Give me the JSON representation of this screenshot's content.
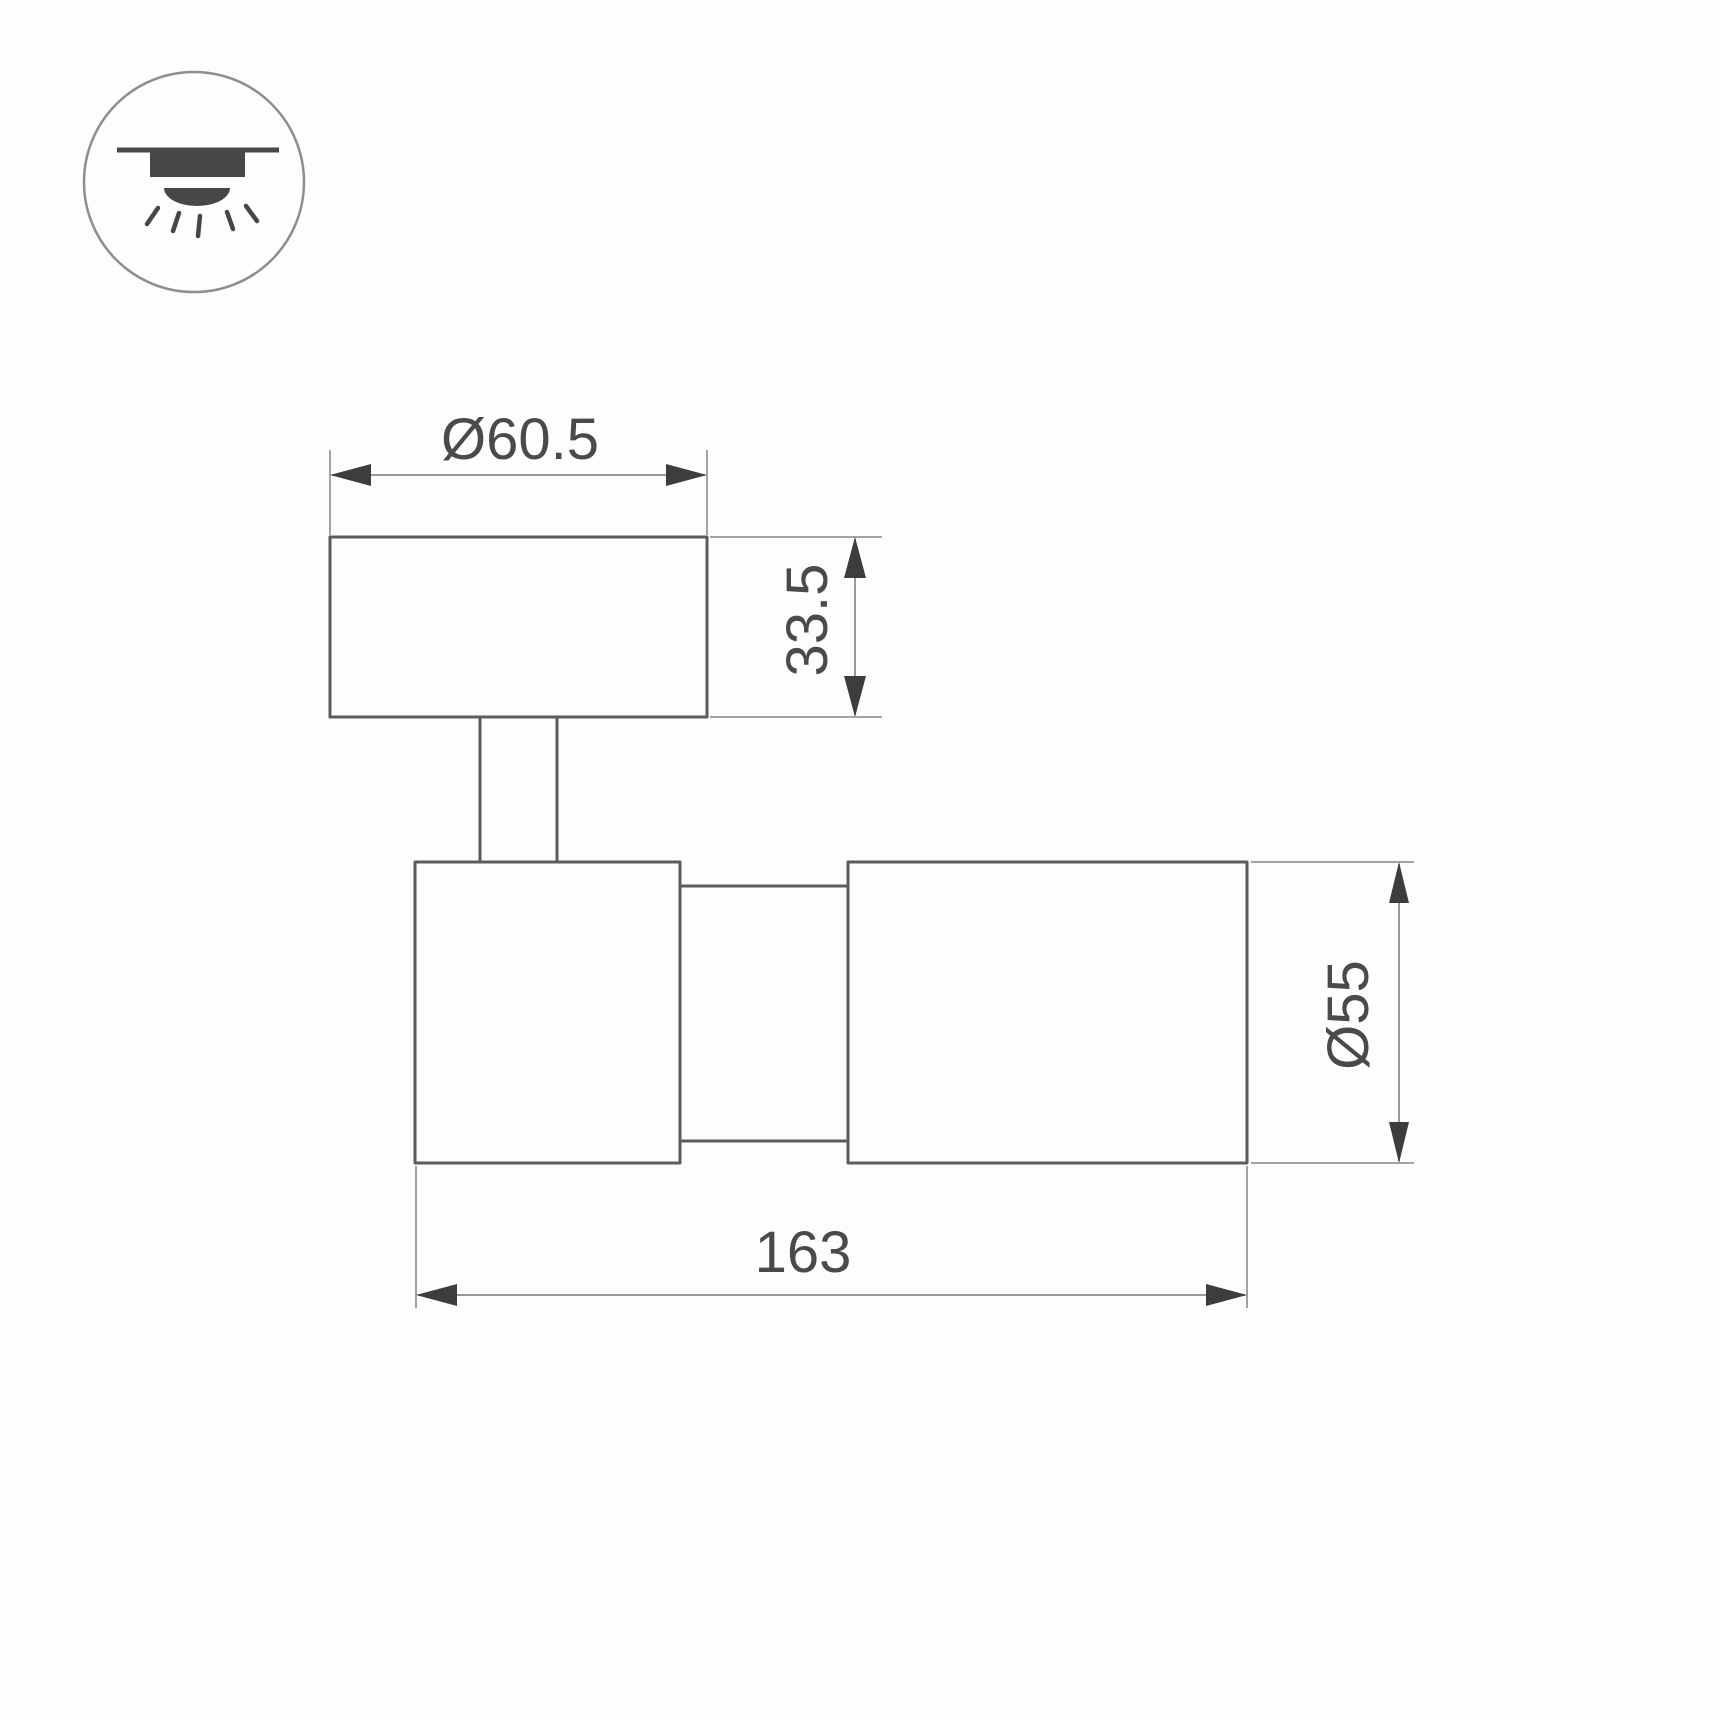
{
  "page": {
    "background": "#fdfdfd",
    "type": "technical-dimension-drawing"
  },
  "icon": {
    "name": "surface-mounted-ceiling-light-icon"
  },
  "dimensions": {
    "canopy_diameter": "Ø60.5",
    "canopy_height": "33.5",
    "body_diameter": "Ø55",
    "overall_length": "163"
  },
  "colors": {
    "outline": "#5c5c5c",
    "dimension_line": "#999999",
    "arrow": "#3d3d3d",
    "label_text": "#4a4a4a",
    "icon_glyph": "#474747",
    "icon_circle": "#8e8e8e"
  }
}
